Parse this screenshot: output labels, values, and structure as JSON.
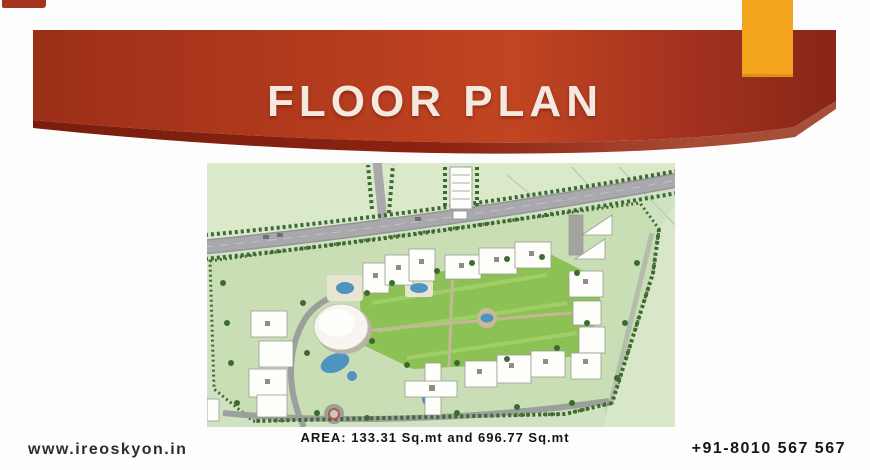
{
  "slide": {
    "title": "FLOOR PLAN",
    "caption": "AREA: 133.31 Sq.mt and 696.77 Sq.mt",
    "footer": {
      "website": "www.ireoskyon.in",
      "phone": "+91-8010 567 567"
    },
    "colors": {
      "banner_left": "#9c2f18",
      "banner_mid": "#b53c1e",
      "banner_bright": "#c14521",
      "banner_fade": "#a53320",
      "banner_right": "#882617",
      "swash_dark": "#7a1d0e",
      "swash_mid": "#8c2211",
      "swash_light": "#a84a34",
      "swash_tip": "#a6503a",
      "accent_orange": "#f2a41d",
      "corner_mark": "#a4331f",
      "title_text": "#f3e9df",
      "caption_text": "#141414",
      "website_text": "#2d2d2d",
      "phone_text": "#161616",
      "plan_bg": "#cfe2c1",
      "plan_field": "#d9e9ca",
      "plan_parcel": "#cadeb5",
      "plan_road": "#a9a9ad",
      "plan_lawn": "#8cc155",
      "plan_water": "#4f93c0",
      "plan_tree": "#3e6a31",
      "plan_building": "#fdfdf9"
    }
  }
}
